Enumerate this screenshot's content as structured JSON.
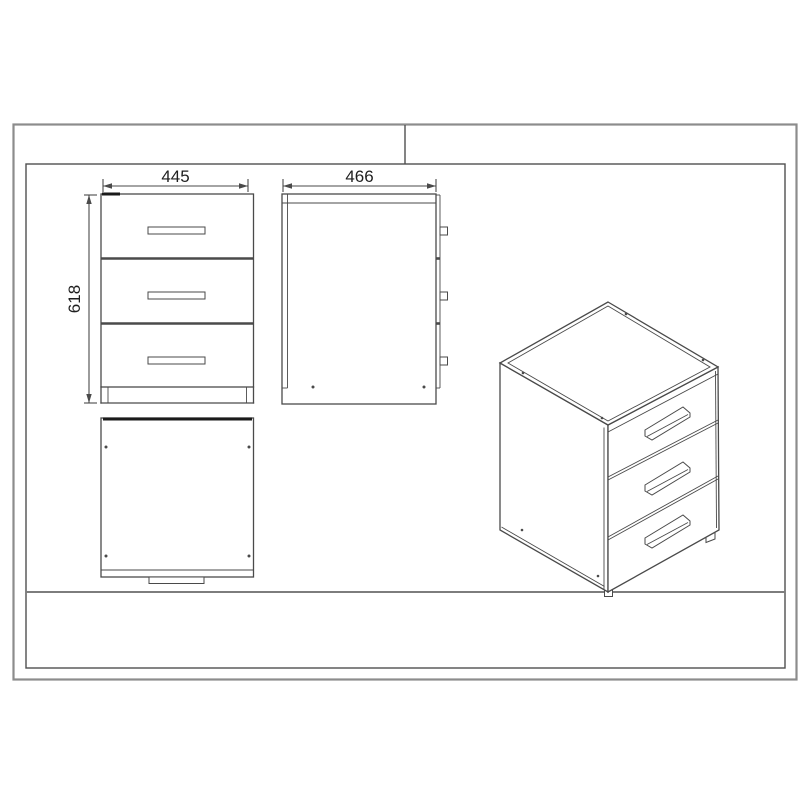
{
  "drawing": {
    "dimensions": {
      "width": "445",
      "depth": "466",
      "height": "618"
    },
    "colors": {
      "line": "#4a4a4a",
      "dark": "#1a1a1a",
      "text": "#1f1f1f",
      "frame_outer": "#8c8c8c",
      "frame_inner": "#4f4f4f",
      "ground": "#7d7d7d",
      "background": "#ffffff"
    }
  }
}
